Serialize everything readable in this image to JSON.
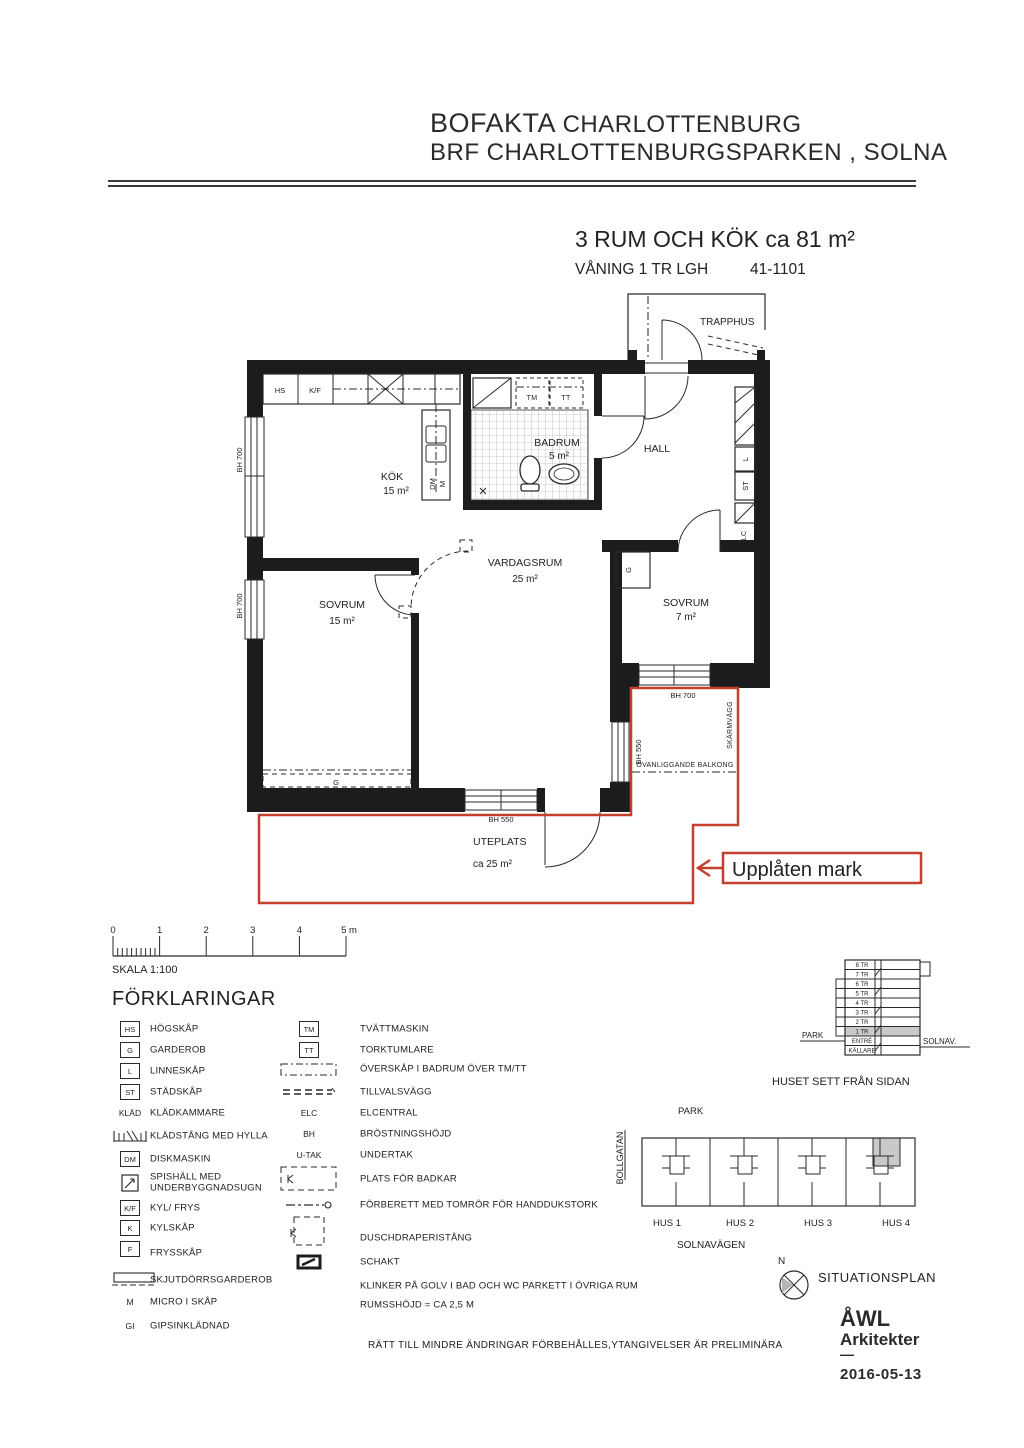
{
  "colors": {
    "red": "#c4402e",
    "wall": "#1c1c1c",
    "highlight": "#c9c9c9"
  },
  "header": {
    "brand": "BOFAKTA",
    "project": "CHARLOTTENBURG",
    "line2": "BRF CHARLOTTENBURGSPARKEN , SOLNA"
  },
  "apartment": {
    "title": "3 RUM OCH KÖK ca 81 m²",
    "floor_label": "VÅNING 1 TR LGH",
    "unit_number": "41-1101"
  },
  "floorplan": {
    "trapphus": "TRAPPHUS",
    "rooms": {
      "kok": {
        "name": "KÖK",
        "area": "15 m²"
      },
      "badrum": {
        "name": "BADRUM",
        "area": "5 m²"
      },
      "hall": {
        "name": "HALL"
      },
      "vardagsrum": {
        "name": "VARDAGSRUM",
        "area": "25 m²"
      },
      "sovrum_stor": {
        "name": "SOVRUM",
        "area": "15 m²"
      },
      "sovrum_liten": {
        "name": "SOVRUM",
        "area": "7 m²"
      },
      "uteplats": {
        "name": "UTEPLATS",
        "area": "ca 25 m²"
      }
    },
    "marks": {
      "hs": "HS",
      "kf": "K/F",
      "tm": "TM",
      "tt": "TT",
      "dm": "DM",
      "m": "M",
      "l": "L",
      "st": "ST",
      "elc": "ELC",
      "g": "G",
      "bh700": "BH 700",
      "bh550": "BH 550",
      "skarmvagg": "SKÄRMVÄGG",
      "ovanliggande": "OVANLIGGANDE BALKONG",
      "upplaten": "Upplåten mark"
    }
  },
  "scalebar": {
    "ticks": [
      "0",
      "1",
      "2",
      "3",
      "4",
      "5 m"
    ],
    "caption": "SKALA 1:100"
  },
  "legend": {
    "title": "FÖRKLARINGAR",
    "left": [
      {
        "sym": "HS",
        "label": "HÖGSKÅP"
      },
      {
        "sym": "G",
        "label": "GARDEROB"
      },
      {
        "sym": "L",
        "label": "LINNESKÅP"
      },
      {
        "sym": "ST",
        "label": "STÄDSKÅP"
      },
      {
        "sym": "KLÄD",
        "label": "KLÄDKAMMARE"
      },
      {
        "sym": "",
        "label": "KLÄDSTÅNG MED HYLLA"
      },
      {
        "sym": "DM",
        "label": "DISKMASKIN"
      },
      {
        "sym": "",
        "label": "SPISHÄLL MED",
        "label2": "UNDERBYGGNADSUGN"
      },
      {
        "sym": "K/F",
        "label": "KYL/ FRYS"
      },
      {
        "sym": "K",
        "label": "KYLSKÅP"
      },
      {
        "sym": "F",
        "label": "FRYSSKÅP"
      },
      {
        "sym": "",
        "label": "SKJUTDÖRRSGARDEROB"
      },
      {
        "sym": "M",
        "label": "MICRO I SKÅP"
      },
      {
        "sym": "GI",
        "label": "GIPSINKLÄDNAD"
      }
    ],
    "right": [
      {
        "sym": "TM",
        "label": "TVÄTTMASKIN"
      },
      {
        "sym": "TT",
        "label": "TORKTUMLARE"
      },
      {
        "sym": "",
        "label": "ÖVERSKÅP I BADRUM ÖVER TM/TT"
      },
      {
        "sym": "",
        "label": "TILLVALSVÄGG"
      },
      {
        "sym": "ELC",
        "label": "ELCENTRAL"
      },
      {
        "sym": "BH",
        "label": "BRÖSTNINGSHÖJD"
      },
      {
        "sym": "U-TAK",
        "label": "UNDERTAK"
      },
      {
        "sym": "",
        "label": "PLATS FÖR BADKAR"
      },
      {
        "sym": "",
        "label": "FÖRBERETT MED TOMRÖR FÖR HANDDUKSTORK"
      },
      {
        "sym": "",
        "label": "DUSCHDRAPERISTÅNG"
      },
      {
        "sym": "",
        "label": "SCHAKT"
      },
      {
        "sym": "",
        "label": "KLINKER PÅ GOLV I BAD OCH WC PARKETT I ÖVRIGA RUM"
      },
      {
        "sym": "",
        "label": "RUMSSHÖJD = CA 2,5 M"
      }
    ]
  },
  "elevation": {
    "floors": [
      "8 TR",
      "7 TR",
      "6 TR",
      "5 TR",
      "4 TR",
      "3 TR",
      "2 TR",
      "1 TR",
      "ENTRÉ",
      "KÄLLARE"
    ],
    "highlighted_floor": "1 TR",
    "left_label": "PARK",
    "right_label": "SOLNAV.",
    "caption": "HUSET SETT FRÅN SIDAN"
  },
  "siteplan": {
    "park": "PARK",
    "street_left": "BOLLGATAN",
    "street_bottom": "SOLNAVÄGEN",
    "houses": [
      "HUS 1",
      "HUS 2",
      "HUS 3",
      "HUS 4"
    ],
    "compass": "N",
    "caption": "SITUATIONSPLAN"
  },
  "footer": {
    "disclaimer": "RÄTT TILL MINDRE ÄNDRINGAR FÖRBEHÅLLES,YTANGIVELSER ÄR PRELIMINÄRA",
    "firm_line1": "ÅWL",
    "firm_line2": "Arkitekter",
    "separator": "—",
    "date": "2016-05-13"
  }
}
